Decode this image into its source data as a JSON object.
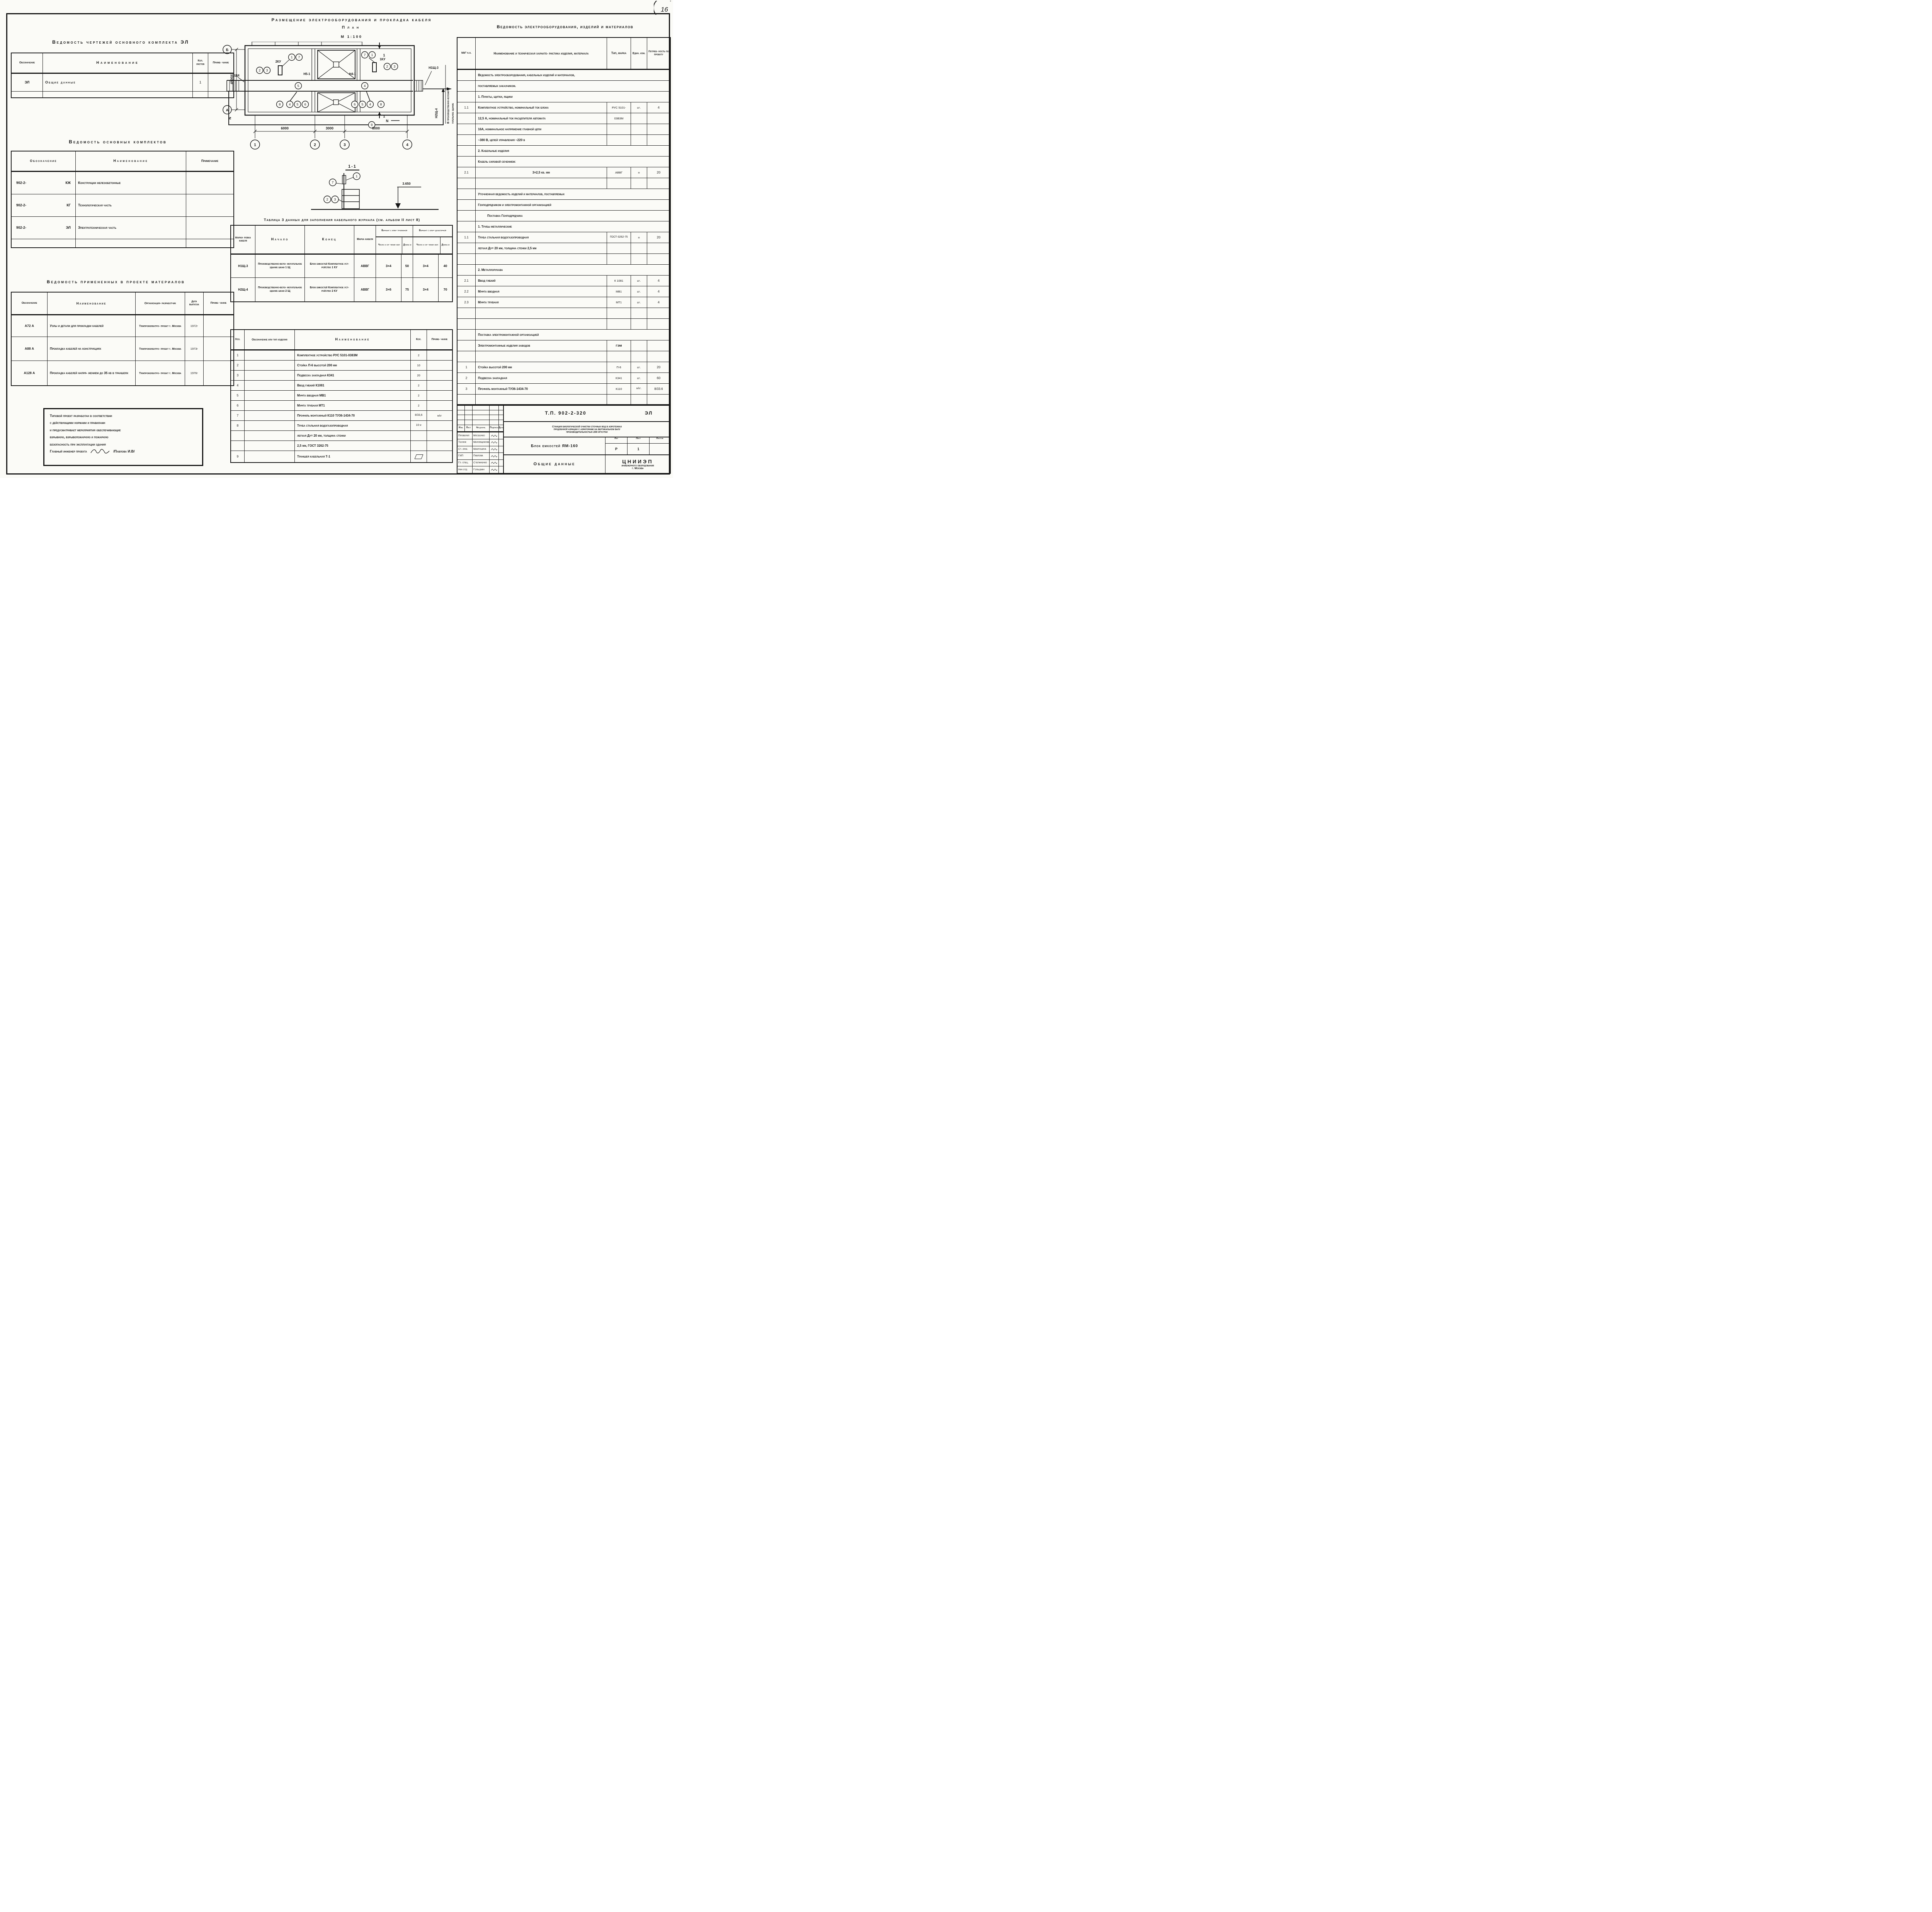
{
  "corner_note": "16",
  "left": {
    "drawings_register": {
      "title": "Ведомость чертежей основного комплекта ЭЛ",
      "col_designation": "Обозначение",
      "col_name": "Наименование",
      "col_sheets": "Кол. листов",
      "col_note": "Приме- чание",
      "rows": [
        {
          "designation": "ЭЛ",
          "name": "Общие данные",
          "sheets": "1",
          "note": ""
        }
      ]
    },
    "main_sets": {
      "title": "Ведомость основных комплектов",
      "col_designation": "Обозначение",
      "col_name": "Наименование",
      "col_note": "Примечание",
      "rows": [
        {
          "designation": "902-2-",
          "code": "КЖ",
          "name": "Конструкции железобетонные",
          "note": ""
        },
        {
          "designation": "902-2-",
          "code": "КГ",
          "name": "Технологическая часть",
          "note": ""
        },
        {
          "designation": "902-2-",
          "code": "ЭЛ",
          "name": "Электротехническая часть",
          "note": ""
        }
      ]
    },
    "materials_register": {
      "title": "Ведомость примененных в проекте материалов",
      "col_designation": "Обозначение",
      "col_name": "Наименование",
      "col_org": "Организация- разработчик",
      "col_date": "Дата выпуска",
      "col_note": "Приме- чание",
      "rows": [
        {
          "designation": "А72 А",
          "name": "Узлы и детали для прокладки кабелей",
          "org": "Тяжпромэлектро- проект г. Москва",
          "date": "1972г",
          "note": ""
        },
        {
          "designation": "А88 А",
          "name": "Прокладка кабелей на конструкциях",
          "org": "Тяжпромэлектро- проект г. Москва",
          "date": "1973г",
          "note": ""
        },
        {
          "designation": "А128 А",
          "name": "Прокладка кабелей напря- жением до 35 кв в траншеях",
          "org": "Тяжпромэлектро- проект г. Москва",
          "date": "1976г",
          "note": ""
        }
      ]
    },
    "note_block": {
      "line1": "Типовой проект разработан в соответствии",
      "line2": "с действующими нормами и правилами",
      "line3": "и предусматривает мероприятия обеспечивающие",
      "line4": "взрывную, взрывопожарную и пожарную",
      "line5": "безопасность при эксплуатации здания",
      "signer_label": "Главный инженер проекта",
      "signer_name": "/Павлова И.В/"
    }
  },
  "plan": {
    "title": "Размещение электрооборудования и прокладка кабеля",
    "subtitle": "План",
    "scale": "М 1:100",
    "nums": [
      "1",
      "2",
      "3",
      "4",
      "5",
      "6",
      "7",
      "8",
      "9"
    ],
    "axes": {
      "a": "А",
      "b": "Б"
    },
    "dims": {
      "w1": "6000",
      "w2": "3000",
      "w3": "6000",
      "h": "4500"
    },
    "labels": {
      "n2sch4": "Н2Щ4",
      "ku2": "2КУ",
      "n5_1": "Н5-1",
      "ku1": "1КУ",
      "n4_1": "Н4-1",
      "n1sch3": "Н1Щ-3",
      "n2sch_4": "Н2Щ-4",
      "dest_line1": "В производственно-вспомо-",
      "dest_line2": "гательное здание",
      "n_mark": "N",
      "section_mark": "1"
    }
  },
  "section": {
    "title": "1-1",
    "elevation": "3.650"
  },
  "cable_table": {
    "title": "Таблица 3 данных для заполнения кабельного журнала (см. альбом II лист 8)",
    "col_mark": "Марки- ровка кабеля",
    "col_start": "Начало",
    "col_end": "Конец",
    "col_cable": "Марка кабеля",
    "col_var_el": "Вариант с элек- тролизной",
    "col_var_chlor": "Вариант с хлор- дозаторной",
    "col_cores": "Число и се- чение жил",
    "col_len": "Длина м",
    "rows": [
      {
        "mark": "Н1Щ-3",
        "start": "Производственно-вспо- могательное здание шкаф 1 Щ",
        "end": "Блок емкостей Комплектное уст- ройство 1 КУ",
        "cable": "АВВГ",
        "cores_el": "3×4",
        "len_el": "50",
        "cores_chlor": "3×4",
        "len_chlor": "40"
      },
      {
        "mark": "Н2Щ-4",
        "start": "Производственно-вспо- могательное здание шкаф 2 Щ",
        "end": "Блок емкостей Комплектное уст- ройство 2 КУ",
        "cable": "АВВГ",
        "cores_el": "3×6",
        "len_el": "75",
        "cores_chlor": "3×4",
        "len_chlor": "70"
      }
    ]
  },
  "parts_table": {
    "col_pos": "Поз.",
    "col_type": "Обозначение или тип изделия",
    "col_name": "Наименование",
    "col_qty": "Кол.",
    "col_note": "Приме- чание",
    "rows": [
      {
        "pos": "1",
        "type": "",
        "name": "Комплектное устройство РУС 5101-0383М",
        "qty": "2",
        "note": ""
      },
      {
        "pos": "2",
        "type": "",
        "name": "Стойка П-6 высотой 200 мм",
        "qty": "10",
        "note": ""
      },
      {
        "pos": "3",
        "type": "",
        "name": "Подвеска закладная К341",
        "qty": "20",
        "note": ""
      },
      {
        "pos": "4",
        "type": "",
        "name": "Ввод гибкий К1081",
        "qty": "2",
        "note": ""
      },
      {
        "pos": "5",
        "type": "",
        "name": "Муфта вводная МВ1",
        "qty": "2",
        "note": ""
      },
      {
        "pos": "6",
        "type": "",
        "name": "Муфта трубная МТ1",
        "qty": "2",
        "note": ""
      },
      {
        "pos": "7",
        "type": "",
        "name": "Профиль монтажный К110 ТУ36-1434-70",
        "qty": "8/33,6",
        "note": "м/кг"
      },
      {
        "pos": "8",
        "type": "",
        "name": "Труба стальная водогазопроводная",
        "qty": "10 м",
        "note": ""
      },
      {
        "pos": "",
        "type": "",
        "name": "легкая Ду= 20 мм, толщина стенки",
        "qty": "",
        "note": ""
      },
      {
        "pos": "",
        "type": "",
        "name": "2,5 мм, ГОСТ 3262-75",
        "qty": "",
        "note": ""
      },
      {
        "pos": "9",
        "type": "",
        "name": "Траншея кабельная Т-1",
        "qty": "",
        "note": ""
      }
    ]
  },
  "equipment_table": {
    "title": "Ведомость электрооборудования, изделий и материалов",
    "col_num": "NN° п.п.",
    "col_name": "Наименование и техническая характе- ристика изделия, материала",
    "col_type": "Тип, марка",
    "col_unit": "Един. изм.",
    "col_qty": "Потреб- ность по проекту",
    "rows": [
      {
        "span": "Ведомость электрооборудования, кабельных изделий и материалов,"
      },
      {
        "span": "поставляемых заказчиком."
      },
      {
        "span": "1. Пункты, щитки, ящики"
      },
      {
        "num": "1.1",
        "name": "Комплектное устройство, номинальный ток блока",
        "type": "РУС 5101-",
        "unit": "шт.",
        "qty": "4"
      },
      {
        "name": "12,5 А, номинальный ток расцепителя автомата",
        "type": "03В3М"
      },
      {
        "name": "16А, номинальное напряжение главной цепи"
      },
      {
        "name": "~380 В, цепей управления ~220 в"
      },
      {
        "span": "2. Кабельные изделия"
      },
      {
        "span": "Кабель силовой сечением:"
      },
      {
        "num": "2.1",
        "name": "3×2,5 кв. мм",
        "type": "АВВГ",
        "unit": "м",
        "qty": "20"
      },
      {},
      {
        "span": "Уточненная ведомость изделий и материалов, поставляемых"
      },
      {
        "span": "Генподрядчиком и электромонтажной организацией"
      },
      {
        "span": "Поставка Генподрядчика"
      },
      {
        "span": "1. Трубы металлические"
      },
      {
        "num": "1.1",
        "name": "Труба стальная водогазопроводная",
        "type": "ГОСТ-3262-75",
        "unit": "м",
        "qty": "20"
      },
      {
        "name": "легкая Ду= 20 мм, толщина стенки 2,5 мм"
      },
      {},
      {
        "span": "2. Металлорукава"
      },
      {
        "num": "2.1",
        "name": "Ввод гибкий",
        "type": "К 1081",
        "unit": "шт.",
        "qty": "4"
      },
      {
        "num": "2.2",
        "name": "Муфта вводная",
        "type": "МВ1",
        "unit": "шт.",
        "qty": "4"
      },
      {
        "num": "2.3",
        "name": "Муфта трубная",
        "type": "МТ1",
        "unit": "шт.",
        "qty": "4"
      },
      {},
      {},
      {
        "span": "Поставка электромонтажной организацией"
      },
      {
        "name": "Электромонтажные изделия заводов",
        "type": "ГЭМ"
      },
      {},
      {
        "num": "1",
        "name": "Стойка высотой 200 мм",
        "type": "П-6",
        "unit": "шт.",
        "qty": "20"
      },
      {
        "num": "2",
        "name": "Подвеска закладная",
        "type": "К341",
        "unit": "шт.",
        "qty": "60"
      },
      {
        "num": "3",
        "name": "Профиль монтажный ТУ36-1434-70",
        "type": "К110",
        "unit": "м/кг.",
        "qty": "8/33.6"
      },
      {}
    ]
  },
  "title_block": {
    "doc_number": "Т.П. 902-2-320",
    "doc_code": "ЭЛ",
    "project_line1": "Станция биологической очистки сточных вод в аэротенках",
    "project_line2": "продленной аэрации с аэраторами на вертикальном валу",
    "project_line3": "производительностью 200 м³/сутки",
    "object": "Блок емкостей ЯМ-160",
    "sheet_title": "Общие данные",
    "org_line1": "ЦНИИЭП",
    "org_line2": "инженерного оборудования",
    "org_line3": "г. Москва",
    "col_izm": "Изм.",
    "col_list": "Лист",
    "col_doc": "№ докум.",
    "col_sign": "Подпись",
    "col_date": "Дата",
    "lit_label": "Лит",
    "sheet_label": "Лист",
    "sheets_label": "Листов",
    "lit_value": "Р",
    "sheet_value": "1",
    "sheets_value": "",
    "staff": [
      {
        "role": "Проверил",
        "name": "Мосеенко"
      },
      {
        "role": "Техник",
        "name": "Меновщикова"
      },
      {
        "role": "Ст. инж.",
        "name": "Макрушина"
      },
      {
        "role": "ГИП",
        "name": "Павлова"
      },
      {
        "role": "Гл. спец.",
        "name": "Степаненко"
      },
      {
        "role": "Нач отд",
        "name": "Гольцман"
      }
    ]
  }
}
